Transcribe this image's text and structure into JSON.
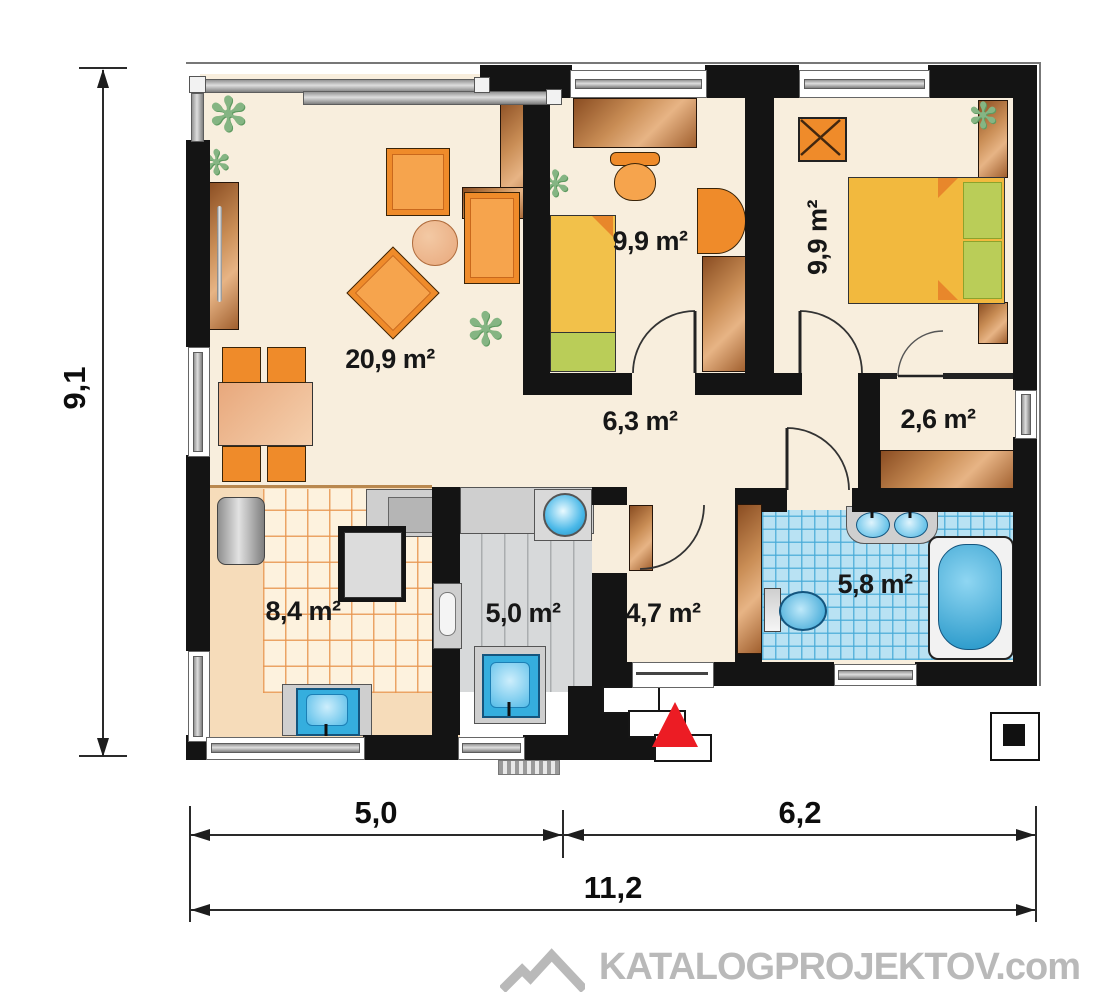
{
  "plan": {
    "rooms": [
      {
        "id": "living-room",
        "area": "20,9 m²"
      },
      {
        "id": "child-room",
        "area": "9,9 m²"
      },
      {
        "id": "bedroom",
        "area": "9,9 m²"
      },
      {
        "id": "hallway",
        "area": "6,3 m²"
      },
      {
        "id": "wardrobe",
        "area": "2,6 m²"
      },
      {
        "id": "kitchen",
        "area": "8,4 m²"
      },
      {
        "id": "utility-room",
        "area": "5,0 m²"
      },
      {
        "id": "entry-hall",
        "area": "4,7 m²"
      },
      {
        "id": "bathroom",
        "area": "5,8 m²"
      }
    ],
    "dimensions": {
      "total_height": "9,1",
      "bottom_left_width": "5,0",
      "bottom_right_width": "6,2",
      "bottom_total_width": "11,2"
    },
    "watermark": "KATALOGPROJEKTOV.com",
    "colors": {
      "wall": "#141414",
      "floor_cream": "#f8eedd",
      "kitchen_tile": "#fdf2de",
      "bathroom_tile": "#b9e2f3",
      "utility_floor": "#d7d9da",
      "furniture_orange": "#ef8b2a",
      "wood_brown": "#b9773f",
      "bed_yellow": "#f2c14a",
      "accent_green": "#b9cc55",
      "entrance_marker_red": "#ec1c24",
      "watermark_gray": "#b9b9b9"
    }
  }
}
